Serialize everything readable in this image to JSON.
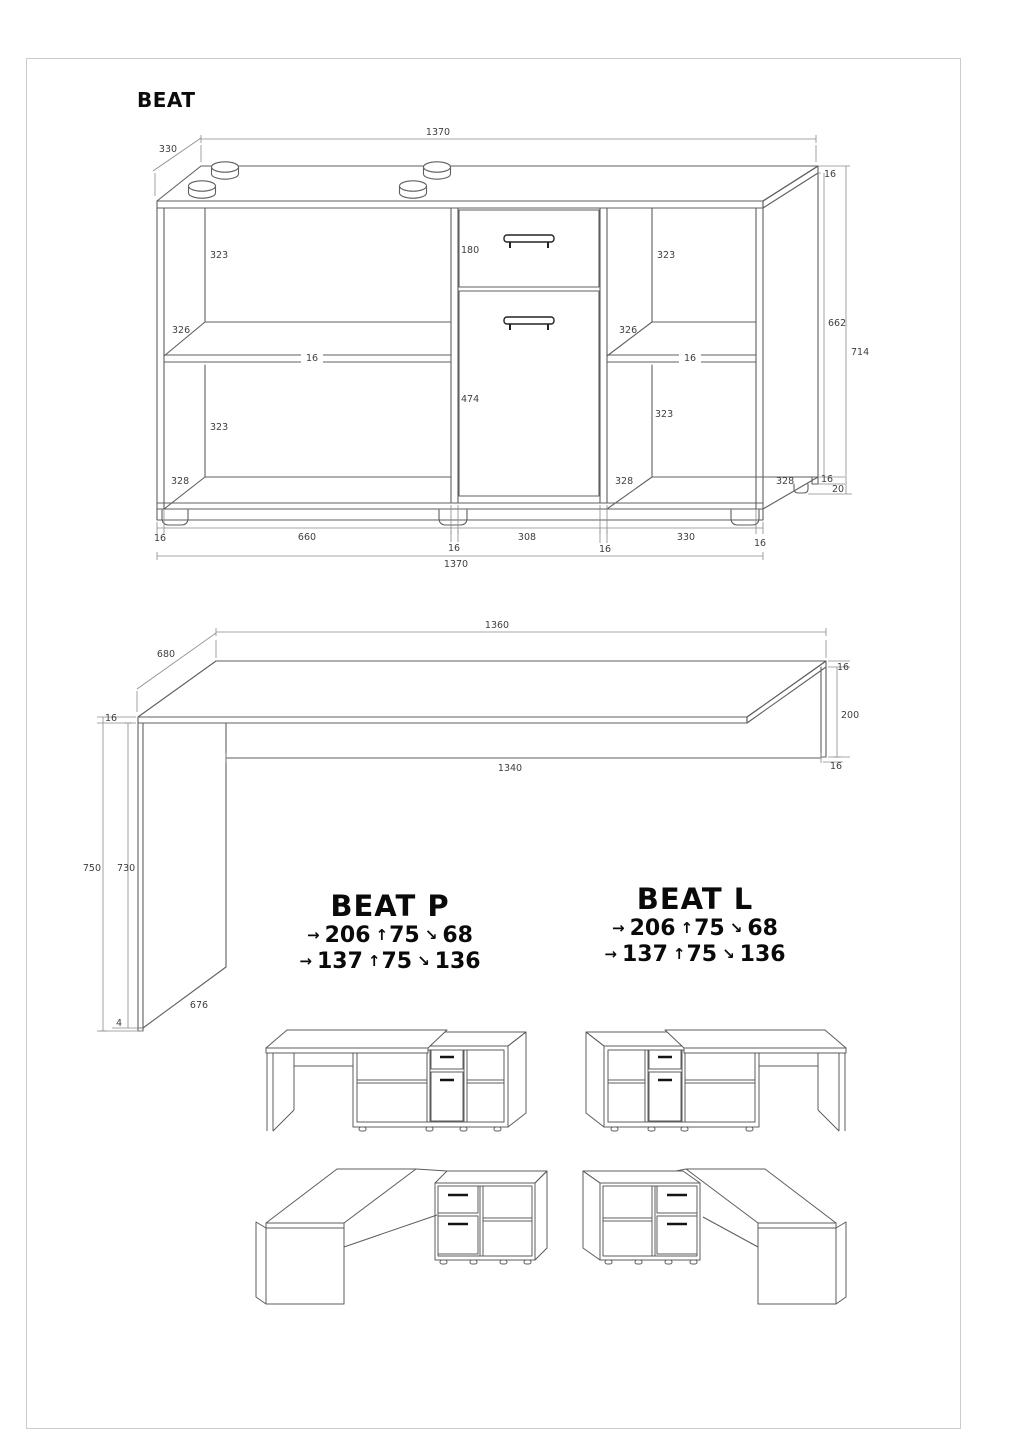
{
  "sheet": {
    "title": "BEAT"
  },
  "cabinet": {
    "width_top": "1370",
    "depth": "330",
    "top_thickness": "16",
    "side_height": "662",
    "total_height": "714",
    "left_opening_top": "323",
    "left_shelf_depth": "326",
    "left_shelf_thickness": "16",
    "left_opening_bottom": "323",
    "left_bottom_depth": "328",
    "drawer_height": "180",
    "door_height": "474",
    "right_opening_top": "323",
    "right_shelf_depth": "326",
    "right_shelf_thickness": "16",
    "right_opening_bottom": "323",
    "right_bottom_depth": "328",
    "side_bottom_depth": "328",
    "bottom_thickness": "16",
    "feet_height": "20",
    "bottom_side_left": "16",
    "bottom_opening_left": "660",
    "bottom_divider_left": "16",
    "bottom_middle": "308",
    "bottom_divider_right": "16",
    "bottom_opening_right": "330",
    "bottom_side_right": "16",
    "width_bottom": "1370"
  },
  "desk": {
    "length_top": "1360",
    "depth": "680",
    "top_thickness_left": "16",
    "top_thickness_right": "16",
    "back_panel_height": "200",
    "back_panel_bottom_thickness": "16",
    "length_under_top": "1340",
    "total_height": "750",
    "leg_height": "730",
    "glide_height": "4",
    "leg_depth": "676"
  },
  "variants": {
    "p": {
      "name": "BEAT P",
      "rows": [
        {
          "width": "206",
          "height": "75",
          "depth": "68"
        },
        {
          "width": "137",
          "height": "75",
          "depth": "136"
        }
      ]
    },
    "l": {
      "name": "BEAT L",
      "rows": [
        {
          "width": "206",
          "height": "75",
          "depth": "68"
        },
        {
          "width": "137",
          "height": "75",
          "depth": "136"
        }
      ]
    }
  },
  "icons": {
    "width_arrow": "→",
    "height_arrow": "↑",
    "depth_arrow": "↘"
  }
}
